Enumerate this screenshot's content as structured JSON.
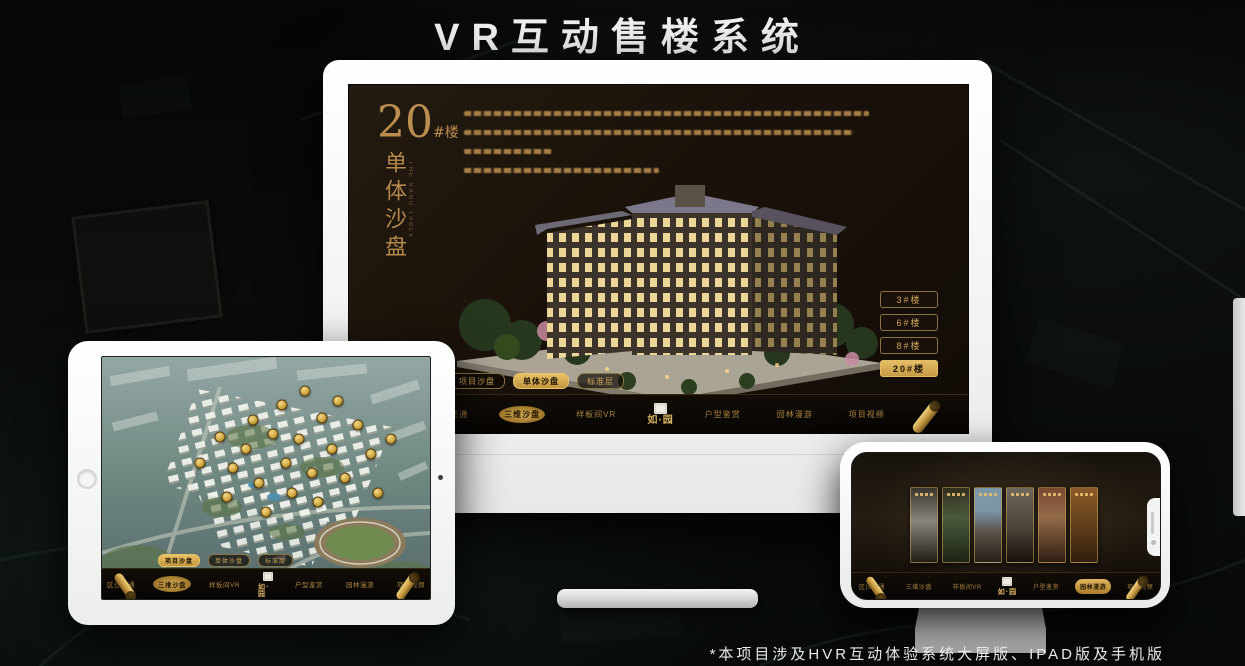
{
  "page": {
    "title": "VR互动售楼系统",
    "footer_note": "*本项目涉及HVR互动体验系统大屏版、IPAD版及手机版"
  },
  "colors": {
    "gold_accent": "#c9a050",
    "gold_bright": "#e8c267",
    "screen_brown": "#1a120a",
    "white_device": "#f4f5f5"
  },
  "monitor": {
    "building_no": "20",
    "building_no_suffix": "#楼",
    "building_name_vertical": "单体沙盘",
    "building_name_caption": "THE SAND TABLE",
    "floor_buttons": [
      {
        "label": "3#楼",
        "active": false
      },
      {
        "label": "6#楼",
        "active": false
      },
      {
        "label": "8#楼",
        "active": false
      },
      {
        "label": "20#楼",
        "active": true
      }
    ],
    "tabs": [
      {
        "label": "项目沙盘",
        "active": false
      },
      {
        "label": "单体沙盘",
        "active": true
      },
      {
        "label": "标准层",
        "active": false
      }
    ],
    "nav": {
      "logo": "如·园",
      "items": [
        {
          "label": "区位交通",
          "active": false
        },
        {
          "label": "三维沙盘",
          "active": true
        },
        {
          "label": "样板间VR",
          "active": false
        },
        {
          "label": "户型鉴赏",
          "active": false
        },
        {
          "label": "园林漫游",
          "active": false
        },
        {
          "label": "项目视频",
          "active": false
        }
      ]
    }
  },
  "tablet": {
    "tabs": [
      {
        "label": "项目沙盘",
        "active": true
      },
      {
        "label": "单体沙盘",
        "active": false
      },
      {
        "label": "标准层",
        "active": false
      }
    ],
    "nav": {
      "logo": "如·园",
      "items": [
        {
          "label": "区位交通",
          "active": false
        },
        {
          "label": "三维沙盘",
          "active": true
        },
        {
          "label": "样板间VR",
          "active": false
        },
        {
          "label": "户型鉴赏",
          "active": false
        },
        {
          "label": "园林漫游",
          "active": false
        },
        {
          "label": "项目视频",
          "active": false
        }
      ]
    },
    "building_markers": [
      [
        62,
        14
      ],
      [
        72,
        18
      ],
      [
        55,
        20
      ],
      [
        46,
        26
      ],
      [
        67,
        25
      ],
      [
        78,
        28
      ],
      [
        36,
        33
      ],
      [
        52,
        32
      ],
      [
        60,
        34
      ],
      [
        44,
        38
      ],
      [
        70,
        38
      ],
      [
        82,
        40
      ],
      [
        30,
        44
      ],
      [
        40,
        46
      ],
      [
        56,
        44
      ],
      [
        64,
        48
      ],
      [
        74,
        50
      ],
      [
        48,
        52
      ],
      [
        58,
        56
      ],
      [
        38,
        58
      ],
      [
        66,
        60
      ],
      [
        50,
        64
      ],
      [
        84,
        56
      ],
      [
        88,
        34
      ]
    ]
  },
  "phone": {
    "nav": {
      "logo": "如·园",
      "items": [
        {
          "label": "区位交通",
          "active": false
        },
        {
          "label": "三维沙盘",
          "active": false
        },
        {
          "label": "样板间VR",
          "active": false
        },
        {
          "label": "户型鉴赏",
          "active": false
        },
        {
          "label": "园林漫游",
          "active": true
        },
        {
          "label": "项目视频",
          "active": false
        }
      ]
    },
    "panels": [
      {
        "name": "ink-courtyard-scene"
      },
      {
        "name": "green-garden-scene"
      },
      {
        "name": "building-sky-scene"
      },
      {
        "name": "residential-tower-scene"
      },
      {
        "name": "autumn-court-scene"
      },
      {
        "name": "warm-interior-scene"
      }
    ]
  }
}
